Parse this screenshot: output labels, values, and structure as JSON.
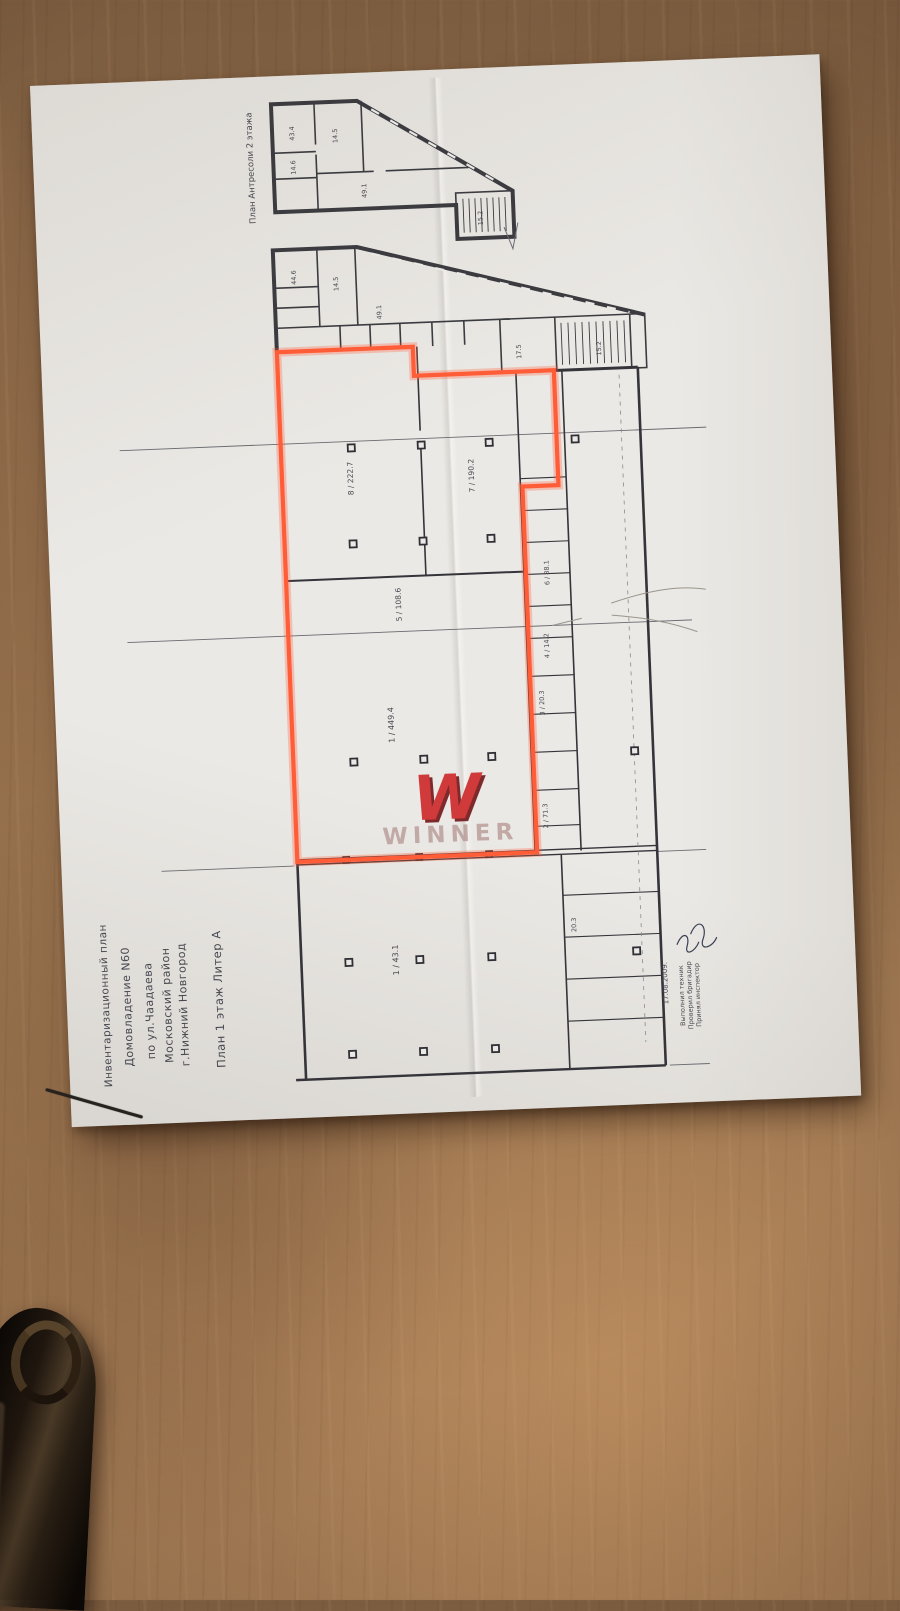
{
  "paper": {
    "side_text": {
      "line1": "Инвентаризационный план",
      "line2": "Домовладение N60",
      "line3": "по ул.Чаадаева",
      "line4": "Московский район",
      "line5": "г.Нижний Новгород",
      "plan_title": "План 1 этаж Литер А"
    },
    "top_plan_label": "План Антресоли 2 этажа",
    "stamp": {
      "date": "17.08.2009.",
      "line1": "Выполнил техник",
      "line2": "Проверил бригадир",
      "line3": "Принял инспектор"
    },
    "watermark": {
      "monogram": "W",
      "text": "WINNER",
      "w_color": "#d03a3a",
      "text_color": "#b89a97"
    },
    "highlight_color": "#ff5c38",
    "rooms": {
      "r8": "8 / 222.7",
      "r7": "7 / 190.2",
      "r5": "5 / 108.6",
      "r1": "1 / 449.4",
      "r6": "6 / 88.1",
      "r4": "4 / 14.2",
      "r3": "3 / 20.3",
      "r2": "2 / 71.3",
      "lower1": "1 / 43.1",
      "lowerR": "20.3",
      "stair1": "17.5",
      "stair2": "15.2",
      "mezz1": "43.4",
      "mezz2": "14.5",
      "mezz3": "14.6",
      "mezz4": "49.1",
      "mezz5": "15.2",
      "mid1": "44.6",
      "mid2": "14.5",
      "mid3": "49.1"
    }
  }
}
